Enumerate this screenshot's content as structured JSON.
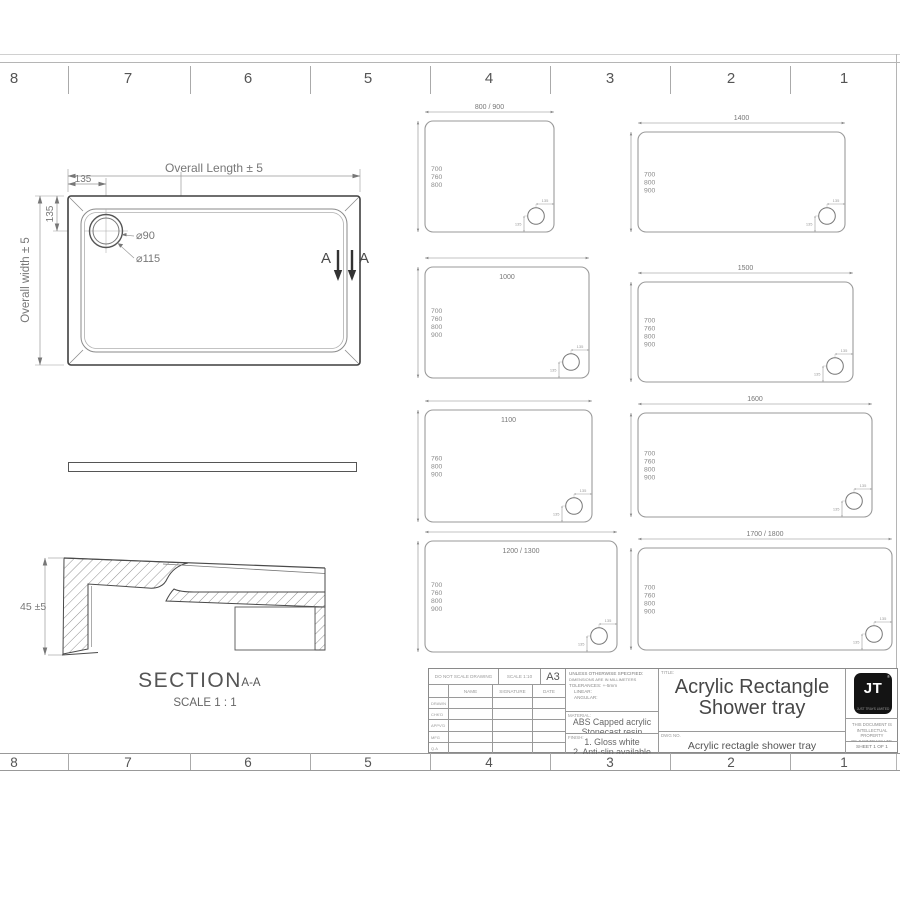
{
  "sheet": {
    "ruler_numbers_top": [
      "8",
      "7",
      "6",
      "5",
      "4",
      "3",
      "2",
      "1"
    ],
    "ruler_numbers_bottom": [
      "8",
      "7",
      "6",
      "5",
      "4",
      "3",
      "2",
      "1"
    ]
  },
  "plan_view": {
    "overall_length_label": "Overall Length ± 5",
    "overall_width_label": "Overall width ± 5",
    "dim_135_horizontal": "135",
    "dim_135_vertical": "135",
    "dim_52": "52",
    "drain_inner_dia": "⌀90",
    "drain_outer_dia": "⌀115",
    "section_letter_left": "A",
    "section_letter_right": "A"
  },
  "section_view": {
    "height_dim": "45 ±5",
    "label": "SECTION",
    "label_suffix": "A-A",
    "scale_label": "SCALE 1 : 1"
  },
  "variants": [
    {
      "width_label": "800 / 900",
      "height_options": [
        "700",
        "760",
        "800"
      ],
      "drain_offset_h": "135",
      "drain_offset_v": "135"
    },
    {
      "width_label": "1400",
      "height_options": [
        "700",
        "800",
        "900"
      ],
      "drain_offset_h": "135",
      "drain_offset_v": "135"
    },
    {
      "width_label": "1000",
      "height_options": [
        "700",
        "760",
        "800",
        "900"
      ],
      "drain_offset_h": "135",
      "drain_offset_v": "135"
    },
    {
      "width_label": "1500",
      "height_options": [
        "700",
        "760",
        "800",
        "900"
      ],
      "drain_offset_h": "135",
      "drain_offset_v": "135"
    },
    {
      "width_label": "1100",
      "height_options": [
        "760",
        "800",
        "900"
      ],
      "drain_offset_h": "135",
      "drain_offset_v": "135"
    },
    {
      "width_label": "1600",
      "height_options": [
        "700",
        "760",
        "800",
        "900"
      ],
      "drain_offset_h": "135",
      "drain_offset_v": "135"
    },
    {
      "width_label": "1200 / 1300",
      "height_options": [
        "700",
        "760",
        "800",
        "900"
      ],
      "drain_offset_h": "135",
      "drain_offset_v": "135"
    },
    {
      "width_label": "1700 / 1800",
      "height_options": [
        "700",
        "760",
        "800",
        "900"
      ],
      "drain_offset_h": "135",
      "drain_offset_v": "135"
    }
  ],
  "title_block": {
    "do_not_scale": "DO NOT SCALE DRAWING",
    "scale": "SCALE 1:10",
    "paper_size": "A3",
    "name_header": "NAME",
    "signature_header": "SIGNATURE",
    "date_header": "DATE",
    "rows": [
      "DRAWN",
      "CHK'D",
      "APPV'D",
      "MFG",
      "Q.A"
    ],
    "spec_lines": [
      "UNLESS OTHERWISE SPECIFIED:",
      "DIMENSIONS ARE IN MILLIMETERS",
      "TOLERANCES: +-5mm",
      "LINEAR:",
      "ANGULAR:"
    ],
    "material_label": "MATERIAL:",
    "material_lines": [
      "ABS Capped acrylic",
      "Stonecast resin"
    ],
    "finish_label": "FINISH:",
    "finish_lines": [
      "1. Gloss white",
      "2. Anti-slip available"
    ],
    "title_label": "TITLE:",
    "title_lines": [
      "Acrylic Rectangle",
      "Shower tray"
    ],
    "dwg_label": "DWG NO.",
    "dwg_no": "Acrylic rectagle shower tray",
    "logo_text": "JT",
    "logo_reg": "®",
    "logo_caption": "JUST TRAYS LIMITED",
    "property_lines": [
      "THIS DOCUMENT IS",
      "INTELLECTUAL PROPERTY",
      "OF JUST TRAYS LTD."
    ],
    "sheet_label": "SHEET 1 OF 1"
  },
  "colors": {
    "drawing_line": "#444444",
    "dimension_text": "#777777",
    "border_gray": "#9a9a9a",
    "logo_bg": "#141414"
  }
}
